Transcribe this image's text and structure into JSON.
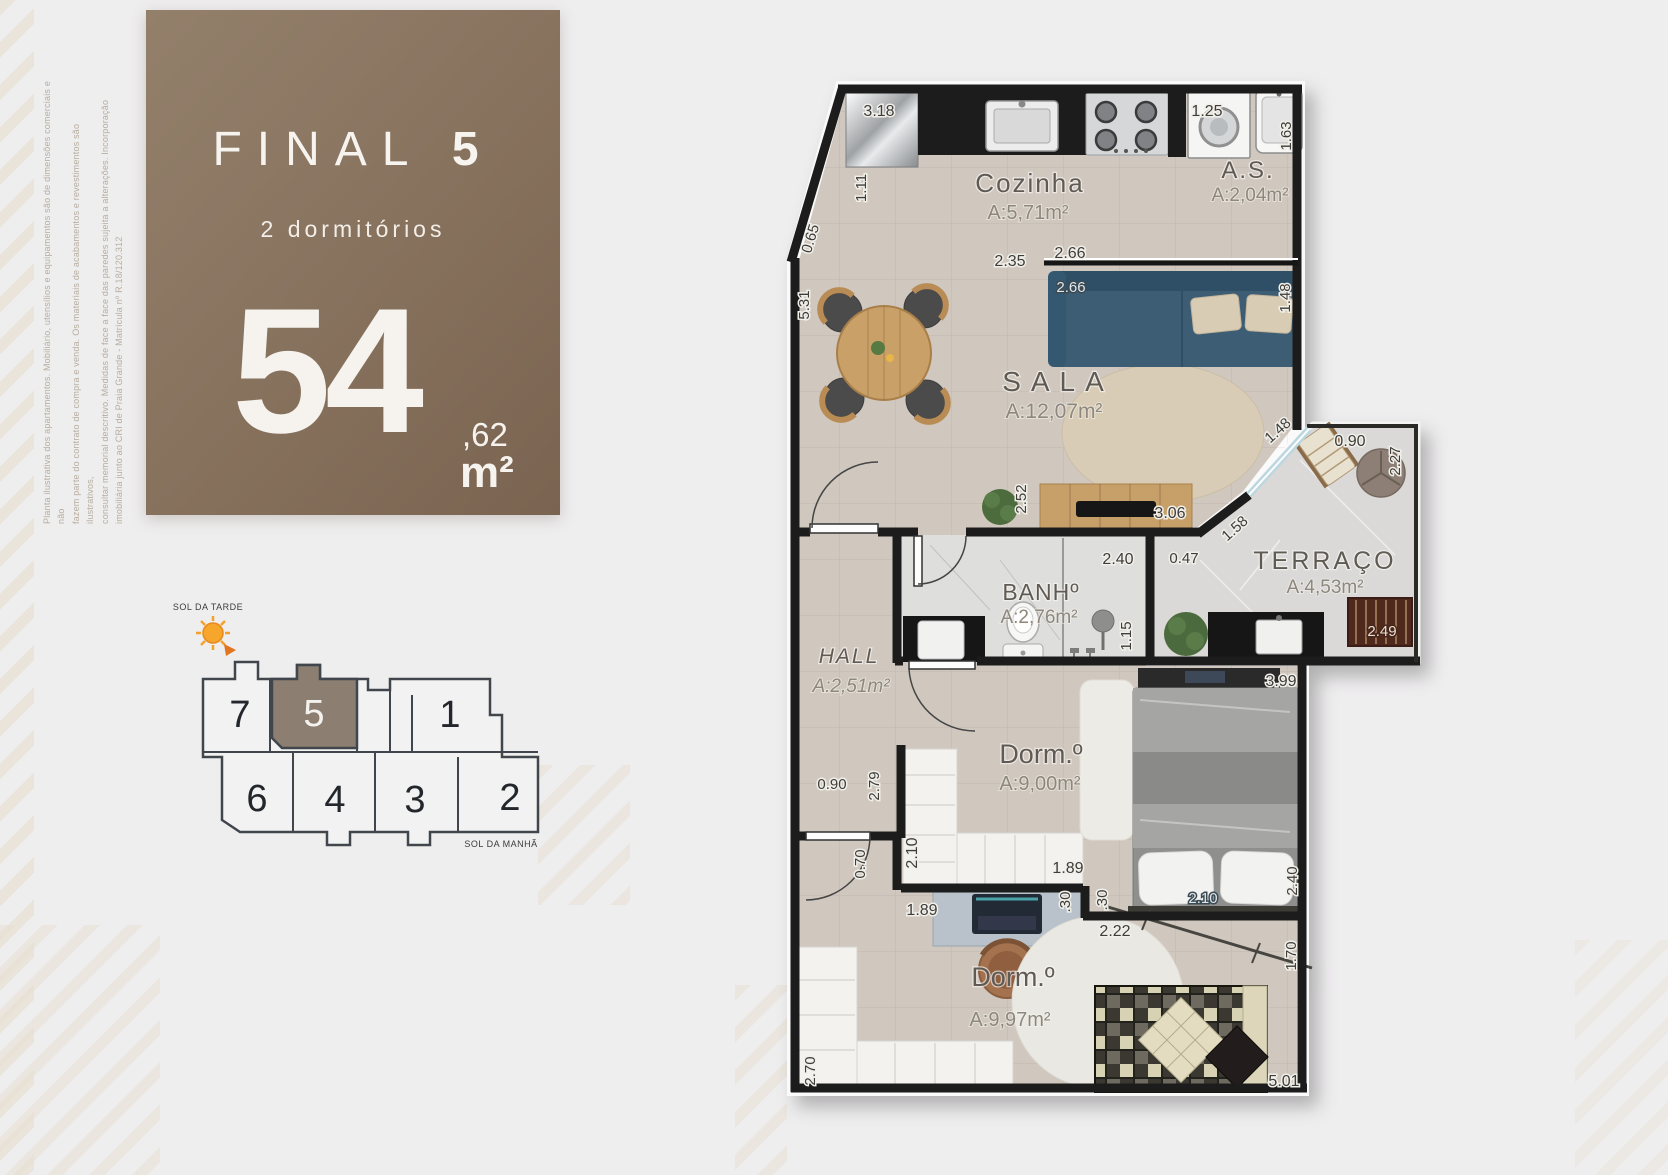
{
  "disclaimer": {
    "lines": [
      "Planta ilustrativa dos apartamentos. Mobiliário, utensílios e equipamentos são de dimensões comerciais e não",
      "fazem parte do contrato de compra e venda. Os materiais de acabamentos e revestimentos são ilustrativos,",
      "consultar memorial descritivo. Medidas de face a face das paredes sujeita a alterações. Incorporação",
      "imobiliária junto ao CRI de Praia Grande - Matrícula nº R.18/120.312"
    ]
  },
  "panel": {
    "title": "FINAL",
    "unit_number": "5",
    "subtitle": "2 dormitórios",
    "area_integer": "54",
    "area_decimal": ",62",
    "area_unit": "m²",
    "accent_color": "#86715d"
  },
  "keyplan": {
    "sun_afternoon_label": "SOL DA TARDE",
    "sun_morning_label": "SOL DA MANHÃ",
    "units": [
      "7",
      "5",
      "1",
      "6",
      "4",
      "3",
      "2"
    ],
    "highlighted_unit": "5",
    "highlight_color": "#8c7e71"
  },
  "floorplan": {
    "rooms": {
      "cozinha": {
        "name": "Cozinha",
        "area": "A:5,71m²"
      },
      "servico": {
        "name": "A.S.",
        "area": "A:2,04m²"
      },
      "sala": {
        "name": "SALA",
        "area": "A:12,07m²"
      },
      "terraco": {
        "name": "TERRAÇO",
        "area": "A:4,53m²"
      },
      "banheiro": {
        "name": "BANHº",
        "area": "A:2,76m²"
      },
      "hall": {
        "name": "HALL",
        "area": "A:2,51m²"
      },
      "dorm1": {
        "name": "Dorm.º",
        "area": "A:9,00m²"
      },
      "dorm2": {
        "name": "Dorm.º",
        "area": "A:9,97m²"
      }
    },
    "dims": {
      "kitchen_fridge": "3.18",
      "kitchen_fridge_depth": "1.11",
      "entry_diagonal": "0.65",
      "sala_left": "5.31",
      "washer": "1.25",
      "service_side": "1.63",
      "kitchen_span_a": "2.35",
      "kitchen_span_b": "2.66",
      "sofa_wall": "2.66",
      "sala_right": "1.48",
      "terrace_top": "0.90",
      "terrace_right": "2.27",
      "terrace_window": "1.48",
      "terrace_diagonal": "1.58",
      "terrace_wall": "0.47",
      "tv_wall": "3.06",
      "sala_depth": "2.52",
      "bath_width": "2.40",
      "bath_depth": "1.15",
      "barbecue": "2.49",
      "dorm1_width": "3.99",
      "hall_width": "0.90",
      "dorm1_entry": "2.79",
      "wardrobe1_depth": "2.10",
      "wardrobe1_width": "1.89",
      "corridor_step": "0.70",
      "step_a": ".30",
      "step_b": ".30",
      "bed1_length": "2.10",
      "dorm1_depth": "2.40",
      "desk_wall": "1.89",
      "dorm2_span": "2.22",
      "dorm2_left": "2.70",
      "dorm2_right": "1.70",
      "dorm2_width": "5.01"
    }
  }
}
